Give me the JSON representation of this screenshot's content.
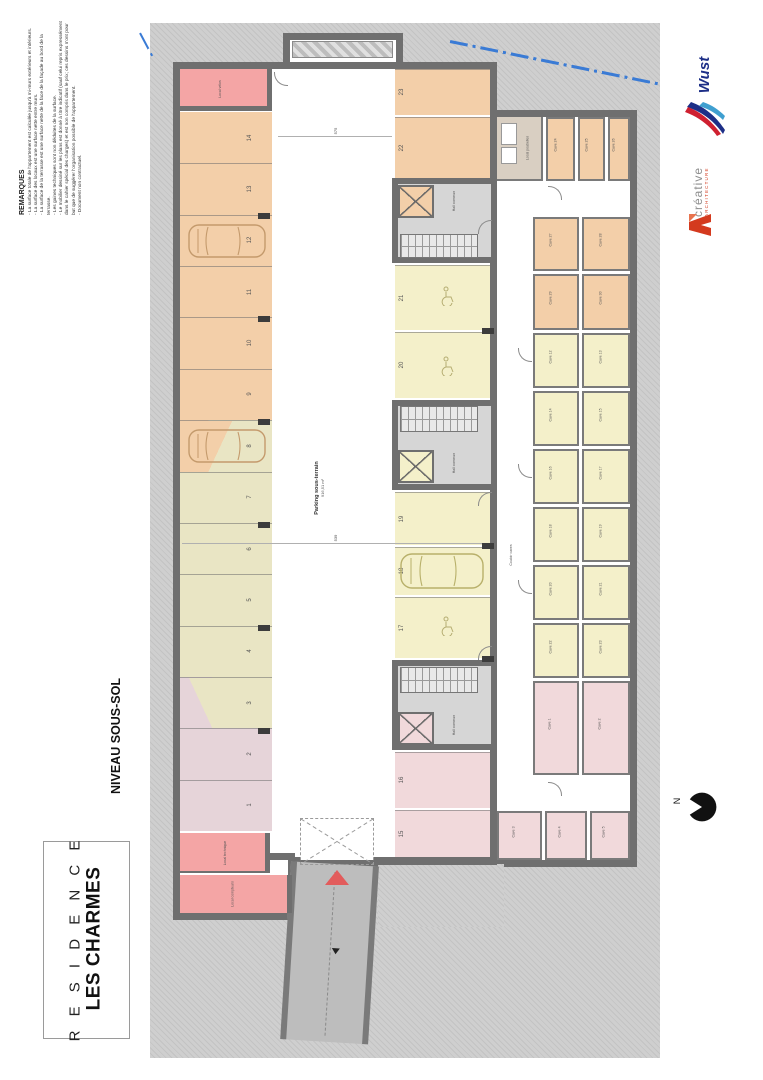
{
  "remarks": {
    "title": "REMARQUES",
    "lines": [
      "- La surface totale de l'appartement est calculée jusqu'à mi-murs extérieurs et intérieurs.",
      "- La surface des locaux est une surface nette entre murs.",
      "- La surface de la terrasse est une surface nette de la face de la façade au bord de la terrasse.",
      "- Les gaines techniques sont non déduites de la surface.",
      "- Le mobilier dessiné sur les plans est donné à titre indicatif (sauf celui repris expressément dans le cahier spécial des charges) et est non compris dans le prix; ces dessins n'ont pour but que de suggérer l'organisation possible de l'appartement.",
      "- Document non contractuel."
    ]
  },
  "titleblock": {
    "line1": "R E S I D E N C E",
    "line2": "LES CHARMES",
    "level": "NIVEAU SOUS-SOL"
  },
  "logos": {
    "wust": "Wust",
    "creative_line1": "créative",
    "creative_line2": "ARCHITECTURE"
  },
  "north_label": "N",
  "plan": {
    "parking_label": "Parking sous-terrain",
    "parking_area": "916,51 m²",
    "hall_label": "Hall commun",
    "corridor_label": "Couloir caves",
    "rooms": {
      "bike": "Local vélos",
      "trash": "Local poubelles",
      "tech": "Local technique",
      "meters": "Local compteurs"
    },
    "dims": {
      "aisle_top": "575",
      "aisle_mid": "539"
    },
    "left_spaces": [
      {
        "n": "14",
        "c": "orange"
      },
      {
        "n": "13",
        "c": "orange"
      },
      {
        "n": "12",
        "c": "orange"
      },
      {
        "n": "11",
        "c": "orange"
      },
      {
        "n": "10",
        "c": "orange"
      },
      {
        "n": "9",
        "c": "orange"
      },
      {
        "n": "8",
        "c": "grad_orange_khaki"
      },
      {
        "n": "7",
        "c": "khaki"
      },
      {
        "n": "6",
        "c": "khaki"
      },
      {
        "n": "5",
        "c": "khaki"
      },
      {
        "n": "4",
        "c": "khaki"
      },
      {
        "n": "3",
        "c": "grad_khaki_mauve"
      },
      {
        "n": "2",
        "c": "mauve"
      },
      {
        "n": "1",
        "c": "mauve"
      }
    ],
    "right_spaces": [
      {
        "n": "23",
        "c": "orange"
      },
      {
        "n": "22",
        "c": "orange"
      },
      {
        "n": "21",
        "c": "yellow",
        "icon": "wheelchair"
      },
      {
        "n": "20",
        "c": "yellow",
        "icon": "wheelchair"
      },
      {
        "n": "19",
        "c": "yellow"
      },
      {
        "n": "18",
        "c": "yellow",
        "icon": "car"
      },
      {
        "n": "17",
        "c": "yellow",
        "icon": "wheelchair"
      },
      {
        "n": "16",
        "c": "pink"
      },
      {
        "n": "15",
        "c": "pink"
      }
    ],
    "caves_orange": [
      "Cave 24",
      "Cave 25",
      "Cave 26",
      "Cave 27",
      "Cave 28",
      "Cave 29",
      "Cave 30"
    ],
    "caves_yellow": [
      "Cave 12",
      "Cave 13",
      "Cave 14",
      "Cave 15",
      "Cave 16",
      "Cave 17",
      "Cave 18",
      "Cave 19",
      "Cave 20",
      "Cave 21",
      "Cave 22",
      "Cave 23"
    ],
    "caves_pink": [
      "Cave 1",
      "Cave 2",
      "Cave 3",
      "Cave 4",
      "Cave 5"
    ]
  },
  "colors": {
    "wall": "#6f6f6f",
    "orange": "#f3cfa9",
    "khaki": "#e9e5c4",
    "yellow": "#f4f0ca",
    "mauve": "#e6d4d9",
    "pink": "#f1d9db",
    "salmon": "#f4a5a5",
    "beige": "#d9cfc2",
    "boundary_blue": "#3a7bd5",
    "ramp_arrow_red": "#e25c5c",
    "wust_blue": "#1d2f87",
    "creative_red": "#d43a1e"
  }
}
